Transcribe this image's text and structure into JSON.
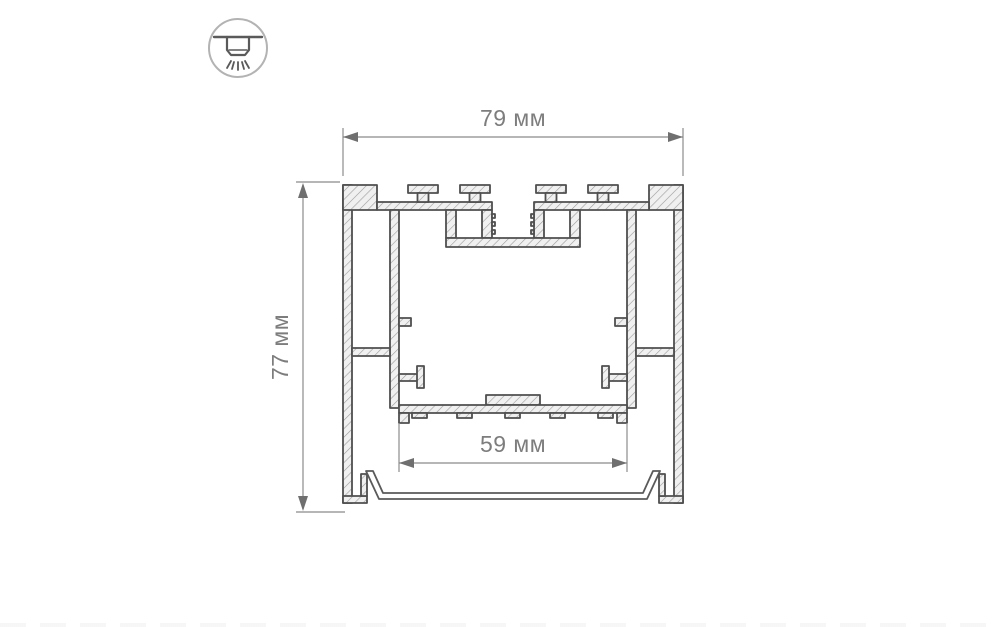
{
  "page": {
    "background": "#ffffff",
    "kind": "product technical drawing"
  },
  "mount_icon": {
    "name": "ceiling-light-icon",
    "depicts": "surface ceiling-mounted luminaire shining downward"
  },
  "drawing": {
    "type": "technical cross-section of aluminium LED profile",
    "dimensions": {
      "width": {
        "label": "79 мм",
        "value": 79,
        "unit": "мм"
      },
      "height": {
        "label": "77 мм",
        "value": 77,
        "unit": "мм"
      },
      "inner_width": {
        "label": "59 мм",
        "value": 59,
        "unit": "мм"
      }
    },
    "colors": {
      "outline": "#4f4f4f",
      "metal_fill": "#f0f0f0",
      "hatch_line": "#9b9b9b",
      "dimension_line": "#8b8b8b",
      "dimension_text": "#7d7d7d",
      "icon_stroke": "#b3b3b3"
    }
  }
}
